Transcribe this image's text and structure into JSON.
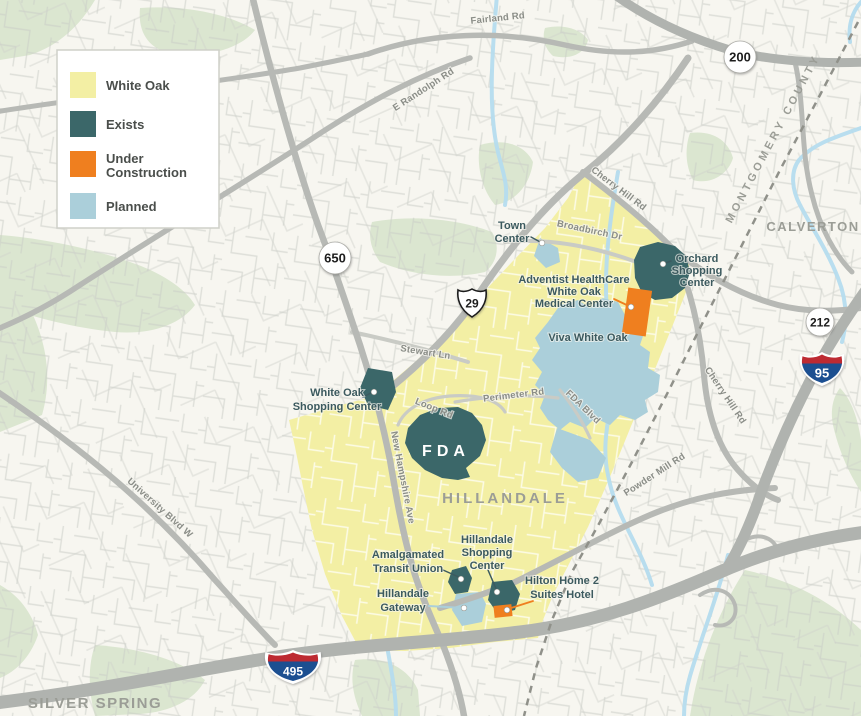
{
  "palette": {
    "white_oak": "#F3EFA4",
    "exists": "#3B6769",
    "under_construction": "#EF7F1F",
    "planned": "#ABCFDA",
    "background": "#F7F6F0",
    "park_green": "#DBE6D0",
    "stream_blue": "#B5DCEE",
    "road_gray": "#B7B9B5"
  },
  "legend": {
    "items": [
      {
        "label": "White Oak",
        "color": "#F3EFA4"
      },
      {
        "label_line1": "Exists",
        "color": "#3B6769"
      },
      {
        "label_line1": "Under",
        "label_line2": "Construction",
        "color": "#EF7F1F"
      },
      {
        "label": "Planned",
        "color": "#ABCFDA"
      }
    ],
    "white_oak": "White Oak",
    "exists": "Exists",
    "under_line1": "Under",
    "under_line2": "Construction",
    "planned": "Planned"
  },
  "shields": {
    "md650": "650",
    "us29": "29",
    "md200": "200",
    "md212": "212",
    "i95": "95",
    "i495": "495"
  },
  "areas": {
    "calverton": "CALVERTON",
    "silver_spring": "SILVER SPRING",
    "hillandale": "HILLANDALE",
    "county_line": "MONTGOMERY COUNTY"
  },
  "roads": {
    "fairland": "Fairland Rd",
    "e_randolph": "E Randolph Rd",
    "cherry_hill_upper": "Cherry Hill Rd",
    "cherry_hill_lower": "Cherry Hill Rd",
    "broadbirch": "Broadbirch Dr",
    "stewart": "Stewart Ln",
    "loop": "Loop Rd",
    "perimeter": "Perimeter Rd",
    "fda_blvd": "FDA Blvd",
    "new_hampshire": "New Hampshire Ave",
    "university": "University Blvd W",
    "powder_mill": "Powder Mill Rd"
  },
  "places": {
    "town_center": {
      "lines": [
        "Town",
        "Center"
      ]
    },
    "adventist": {
      "lines": [
        "Adventist HealthCare",
        "White Oak",
        "Medical Center"
      ]
    },
    "orchard": {
      "lines": [
        "Orchard",
        "Shopping",
        "Center"
      ]
    },
    "viva": {
      "label": "Viva White Oak"
    },
    "white_oak_sc": {
      "lines": [
        "White Oak",
        "Shopping Center"
      ]
    },
    "fda": {
      "label": "FDA"
    },
    "atu": {
      "lines": [
        "Amalgamated",
        "Transit Union"
      ]
    },
    "hillandale_sc": {
      "lines": [
        "Hillandale",
        "Shopping",
        "Center"
      ]
    },
    "hillandale_gw": {
      "lines": [
        "Hillandale",
        "Gateway"
      ]
    },
    "hilton": {
      "lines": [
        "Hilton Home 2",
        "Suites Hotel"
      ]
    }
  }
}
